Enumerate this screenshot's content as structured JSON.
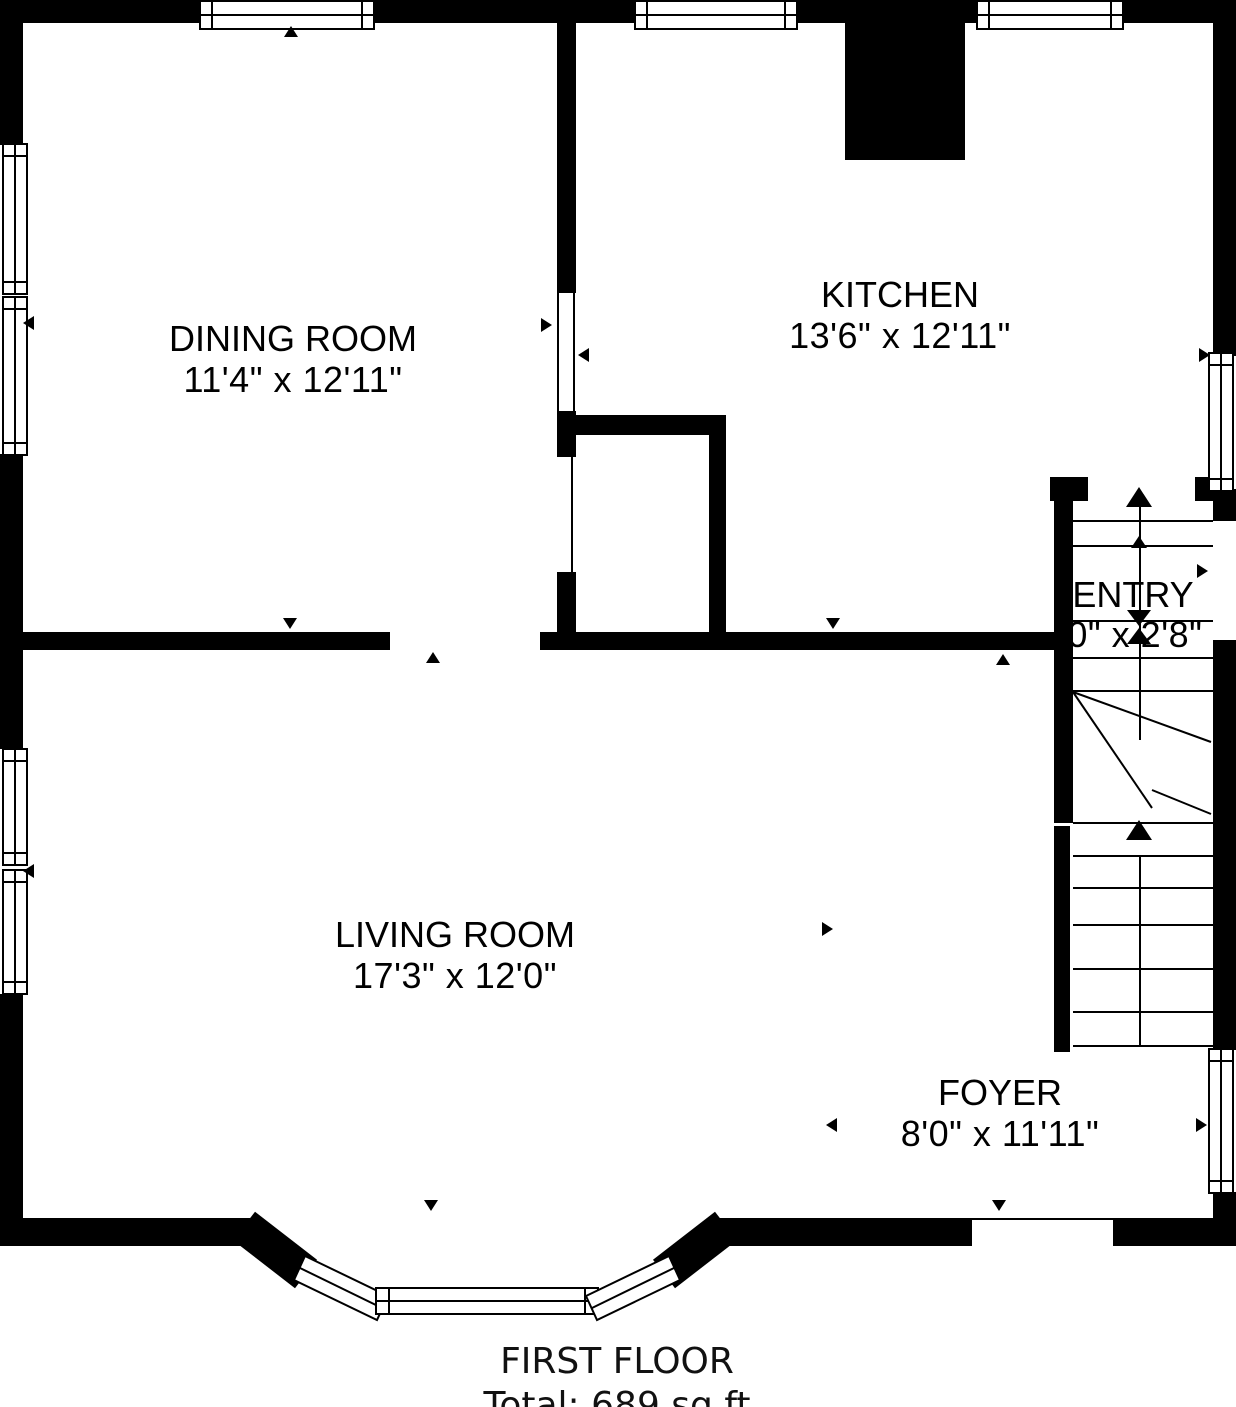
{
  "plan": {
    "footer": {
      "title": "FIRST FLOOR",
      "total": "Total: 689 sq ft"
    },
    "rooms": [
      {
        "id": "dining",
        "name": "DINING ROOM",
        "dims": "11'4\" x 12'11\""
      },
      {
        "id": "kitchen",
        "name": "KITCHEN",
        "dims": "13'6\" x 12'11\""
      },
      {
        "id": "entry",
        "name": "ENTRY",
        "dims": "'0\" x 2'8\""
      },
      {
        "id": "living",
        "name": "LIVING ROOM",
        "dims": "17'3\" x 12'0\""
      },
      {
        "id": "foyer",
        "name": "FOYER",
        "dims": "8'0\" x 11'11\""
      }
    ],
    "colors": {
      "wall": "#000000",
      "floor": "#ffffff"
    }
  }
}
